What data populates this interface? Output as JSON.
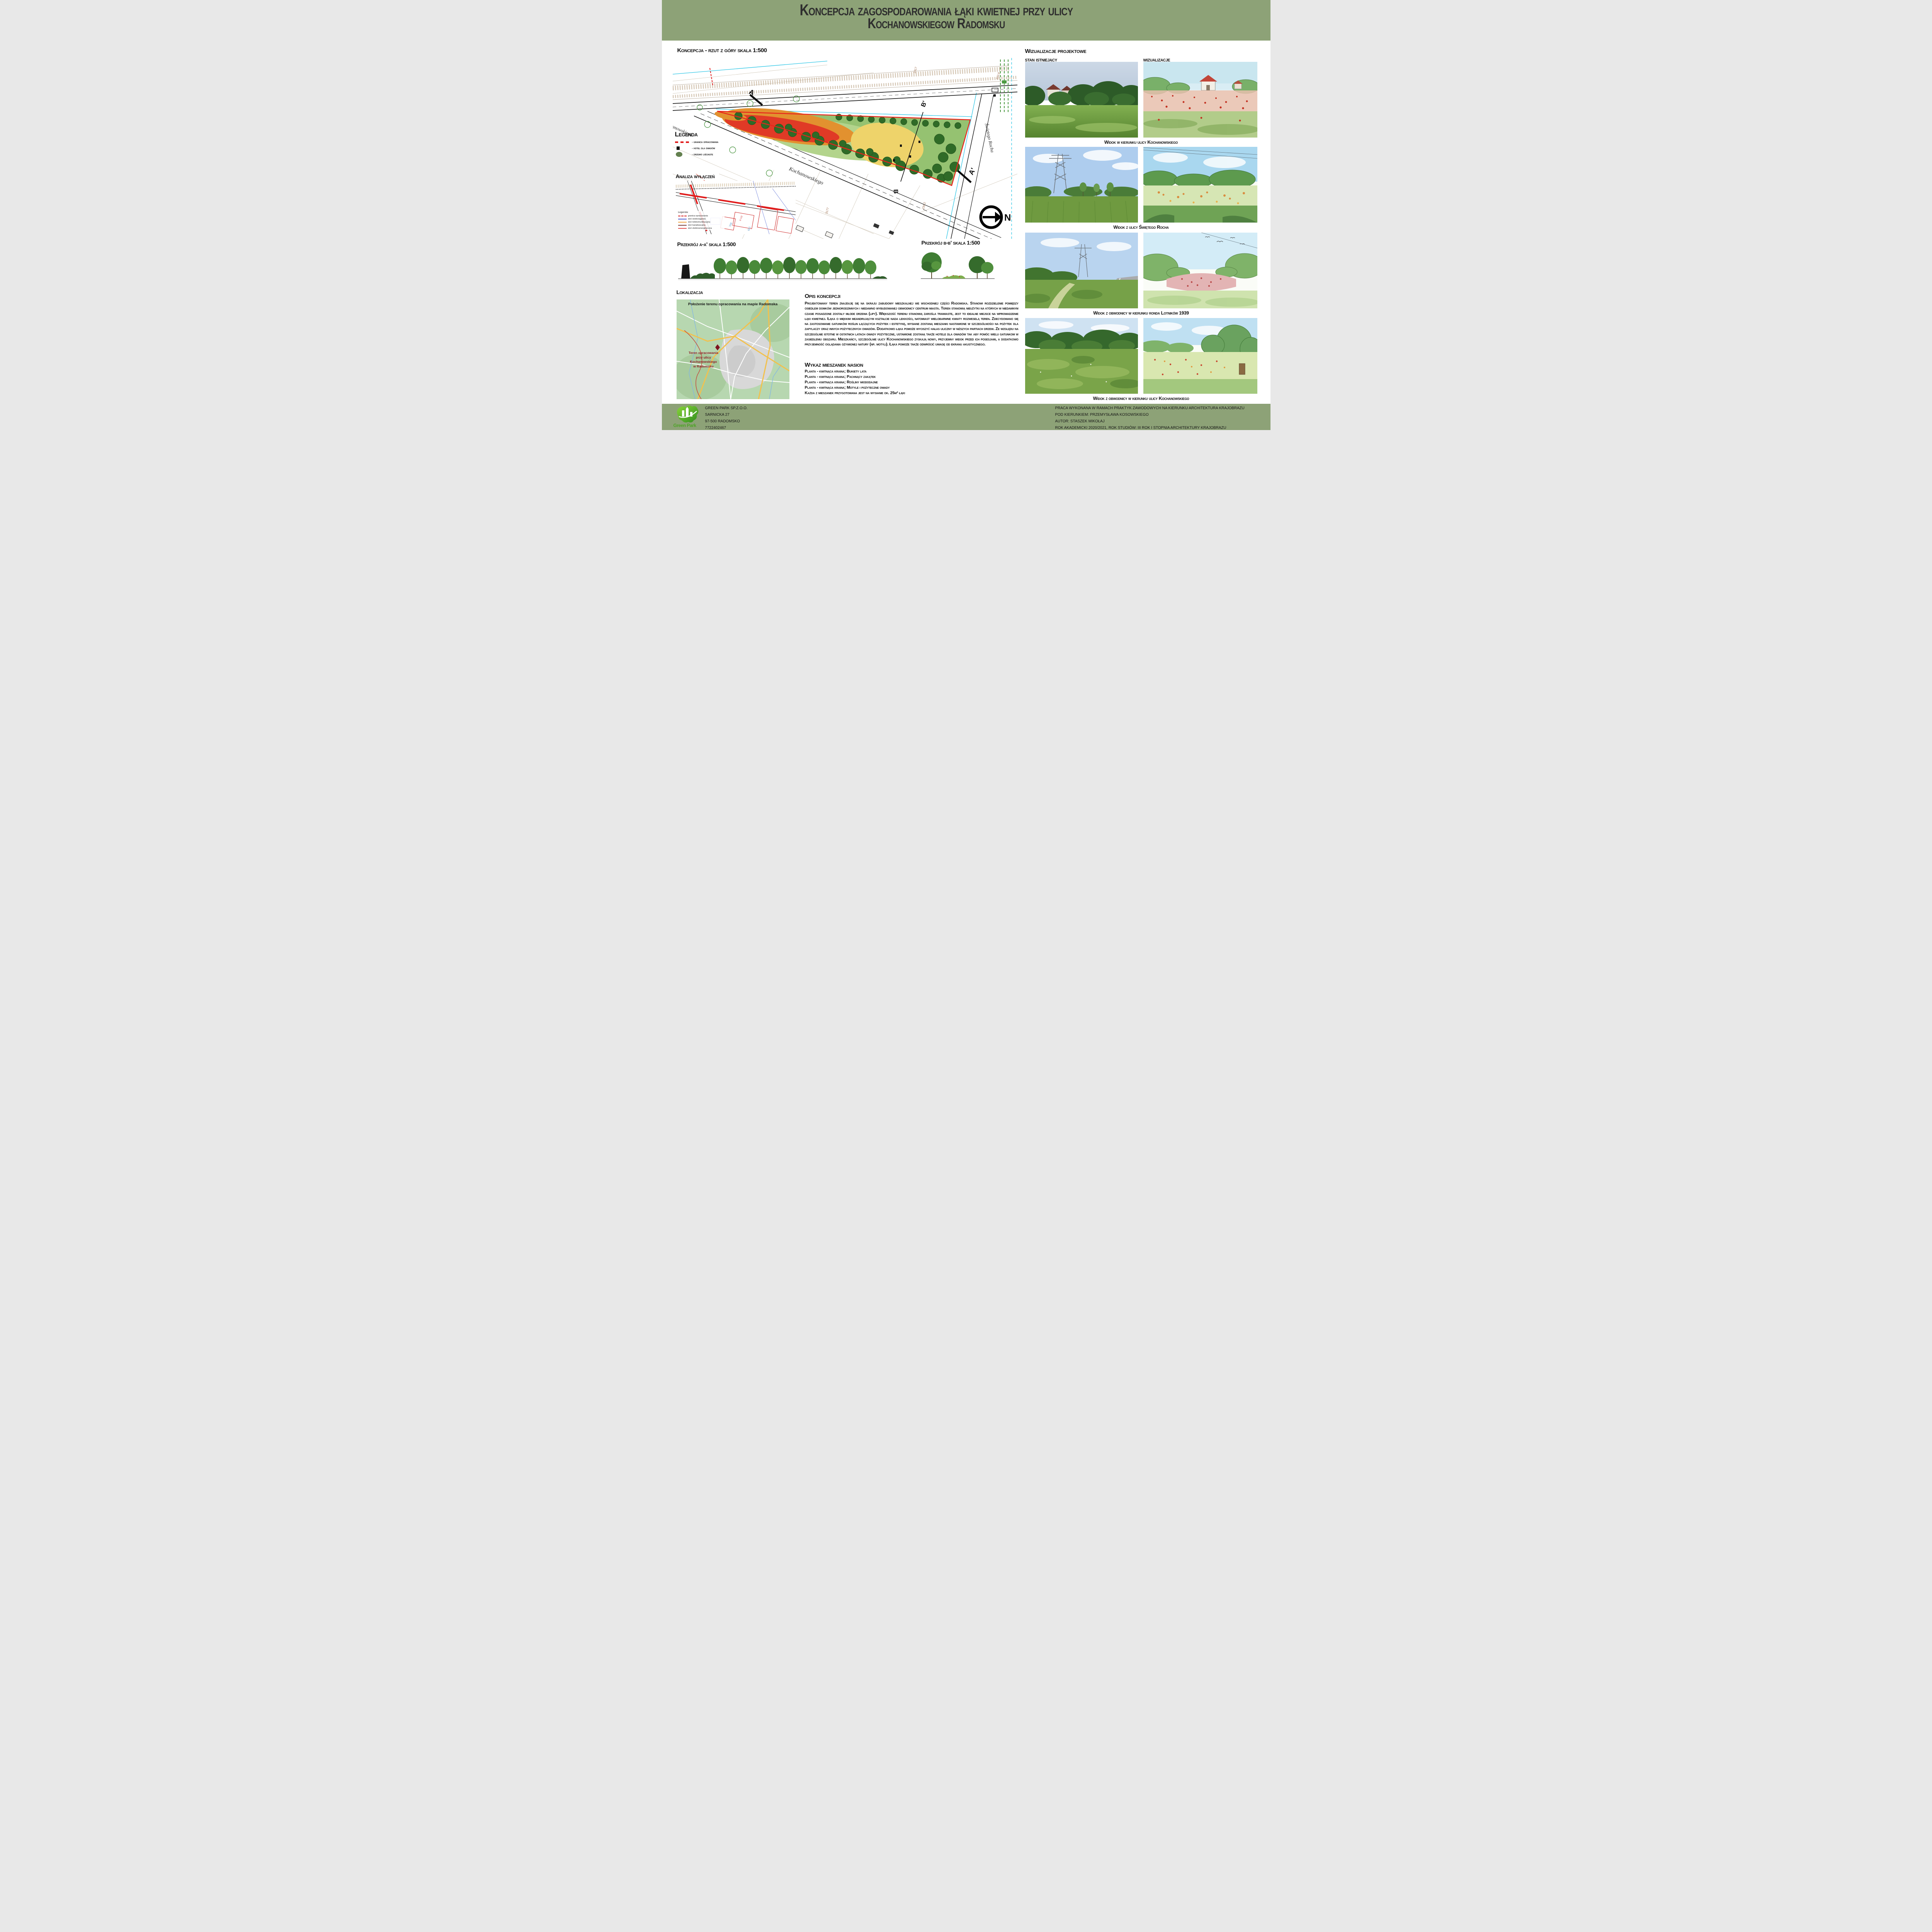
{
  "header": {
    "title_line1": "Koncepcja zagospodarowania łąki kwietnej przy ulicy",
    "title_line2": "Kochanowskiegow Radomsku"
  },
  "plan": {
    "heading": "Koncepcja - rzut z góry skala 1:500",
    "street_main": "Kochanowskiego",
    "street_side": "Świętego Rocha",
    "section_a": "A",
    "section_a_end": "A'",
    "section_b": "B",
    "section_b_end": "B'",
    "north": "N",
    "parcel_labels": [
      "2317",
      "233.8",
      "234.2",
      "3177",
      "770/1"
    ]
  },
  "legend": {
    "heading": "Legenda",
    "items": [
      {
        "label": "- granica opracowania",
        "symbol": "red-dashed-line",
        "color": "#e01b1b"
      },
      {
        "label": "- hotel dla owadów",
        "symbol": "black-square",
        "color": "#111111"
      },
      {
        "label": "- drzewo liściaste",
        "symbol": "green-circle",
        "color": "#63804f"
      }
    ]
  },
  "analysis": {
    "heading": "Analiza wyłączeń",
    "legend_title": "Legenda:",
    "items": [
      {
        "label": "granica opracowania",
        "color": "#d42020",
        "style": "dashed"
      },
      {
        "label": "sieć wodociągowa",
        "color": "#4a5bd0",
        "style": "solid"
      },
      {
        "label": "sieć telekomunikacyjna",
        "color": "#efa23d",
        "style": "solid"
      },
      {
        "label": "sieć kanalizacyjna",
        "color": "#7c3f3a",
        "style": "solid"
      },
      {
        "label": "sieć elektroenergetyczna",
        "color": "#e4504e",
        "style": "solid"
      }
    ],
    "map_labels": [
      "8-132",
      "768",
      "601"
    ]
  },
  "sections": {
    "a_heading": "Przekrój a-a' skala 1:500",
    "b_heading": "Przekrój b-b' skala 1:500"
  },
  "location": {
    "heading": "Lokalizacja",
    "map_title": "Położenie terenu opracowania na mapie Radomska",
    "marker_line1": "Teren opracowania",
    "marker_line2": "przy ulicy",
    "marker_line3": "Kochanowskiego",
    "marker_line4": "w Radomsku"
  },
  "description": {
    "heading": "Opis koncepcji",
    "body": "Projektowany teren znajduję się na skraju zabudowy mieszkalnej we wschodniej części Radomska. Stanowi rozdzielenie pomiędzy osiedlem domków jednorodzinnych i niedawno wybudowanej obwodnicy centrum miasta. Teren stanowią nieużytki na których w niedawnym czasie posadzone zostały młode drzewa (lipy). Większość terenu stanowią zarośla trawiaste, jest to idealne miejsce na wprowadzenie łąki kwietnej. Łąka o miękkim meandrującym kształcie nada lekkości, natomiast wielobarwne kwiaty rozweselą teren. Zdecydowano się na zastosowanie gatunków roślin łączących pożytek i estetykę, wysiane zostaną mieszanki nastawione w szczególności na pożytek dla zapylaczy oraz innych pożytecznych owadów. Dodatkowo łąka pomoże wyciszyć hałas uliczny w niższych partiach drzew. Ze względu na szczególnie istotne w ostatnich latach owady pożyteczne, ustawione zostaną także hotele dla owadów tak aby pomóc wielu gatunkom w zasiedleniu obszaru. Mieszkańcy, szczególnie ulicy Kochanowskiego zyskają nowy, przyjemny widok przed ich posesjami, a dodatkowo przyjemność oglądania ożywionej natury (np. motyli). Łąka pomoże także odwrócić uwagę od ekranu akustycznego."
  },
  "seed_mixes": {
    "heading": "Wykaz mieszanek nasion",
    "items": [
      "Planta - kwitnąca kraina; Bukiety lata",
      "Planta - kwitnąca kraina; Pachnący zakątek",
      "Planta - kwitnąca kraina; Rośliny miododajne",
      "Planta - kwitnąca kraina; Motyle i pożyteczne owady"
    ],
    "note": "Każda z mieszanek przygotowana jest na wysianie ok. 25m² łąki"
  },
  "visualizations": {
    "heading": "Wizualizacje projektowe",
    "column_left": "stan istniejący",
    "column_right": "wizualizacje",
    "rows": [
      {
        "caption": "Widok w kierunku ulicy Kochanowskiego"
      },
      {
        "caption": "Widok z ulicy Świętego Rocha"
      },
      {
        "caption": "Widok z obwodnicy w kierunku ronda Lotników 1939"
      },
      {
        "caption": "Widok z obwodnicy w kierunku ulicy Kochanowskiego"
      }
    ]
  },
  "footer": {
    "company": {
      "logo_text": "Green Park",
      "line1": "GREEN PARK SP.Z.O.O.",
      "line2": "SARNICKA 27",
      "line3": "97-500 RADOMSKO",
      "line4": "7722402467"
    },
    "credits": [
      "PRACA WYKONANA W RAMACH PRAKTYK ZAWODOWYCH NA KIERUNKU ARCHITEKTURA KRAJOBRAZU",
      "POD KIERUNKIEM: PRZEMYSŁAWA KOSOWSKIEGO",
      "AUTOR: STASZEK MIKOŁAJ",
      "ROK AKADEMICKI 2020/2021, ROK STUDIÓW: III ROK I STOPNIA ARCHITEKTURY KRAJOBRAZU"
    ]
  },
  "colors": {
    "band_olive": "#8da277",
    "boundary_red": "#e01b1b",
    "meadow_green": "#95c271",
    "tree_green": "#2f6b27",
    "meander_red": "#e03a26",
    "meander_orange": "#e2912f",
    "meadow_yellow": "#eed36a",
    "marker_red": "#8e1b24",
    "logo_green": "#4ea427"
  }
}
